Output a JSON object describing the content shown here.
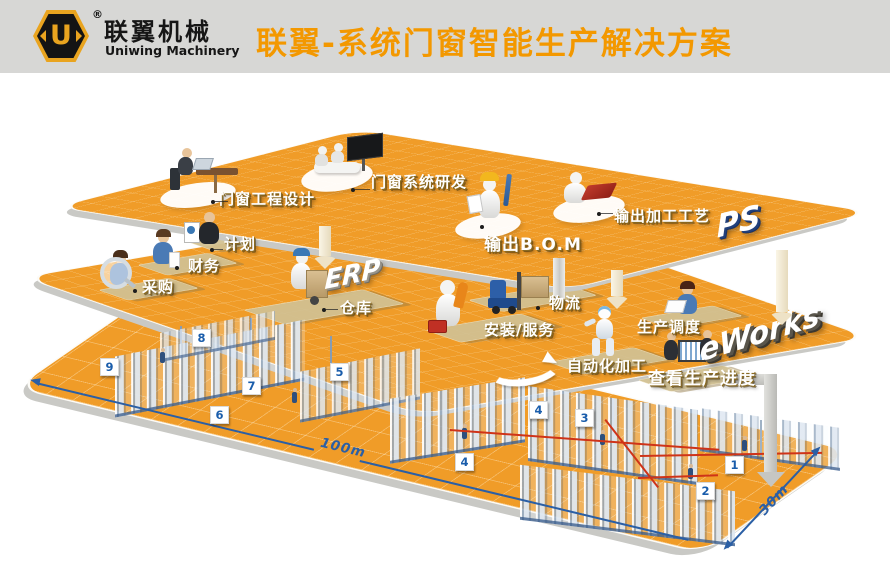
{
  "header": {
    "monogram": "U",
    "registered": "®",
    "brand_cn": "联翼机械",
    "brand_en": "Uniwing Machinery",
    "title": "联翼-系统门窗智能生产解决方案"
  },
  "colors": {
    "accent_orange": "#f39800",
    "platform_orange": "#f09c28",
    "marker_blue": "#1a5dab",
    "dimension_blue": "#2b5fa5",
    "flow_red": "#cf3318",
    "pad_tan": "#d2c192"
  },
  "layers": {
    "design": {
      "logo": "PS",
      "stations": {
        "engineering": "门窗工程设计",
        "research": "门窗系统研发",
        "bom": "输出B.O.M",
        "process": "输出加工工艺"
      }
    },
    "erp": {
      "logo": "ERP",
      "logo2": "eWorks",
      "stations": {
        "plan": "计划",
        "finance": "财务",
        "purchase": "采购",
        "warehouse": "仓库",
        "logistics": "物流",
        "install": "安装/服务",
        "dispatch": "生产调度",
        "auto": "自动化加工",
        "progress": "查看生产进度"
      }
    },
    "factory": {
      "markers": [
        "1",
        "2",
        "3",
        "4",
        "4",
        "5",
        "6",
        "7",
        "8",
        "9"
      ],
      "dimensions": {
        "length": "100m",
        "width": "30m"
      }
    }
  }
}
